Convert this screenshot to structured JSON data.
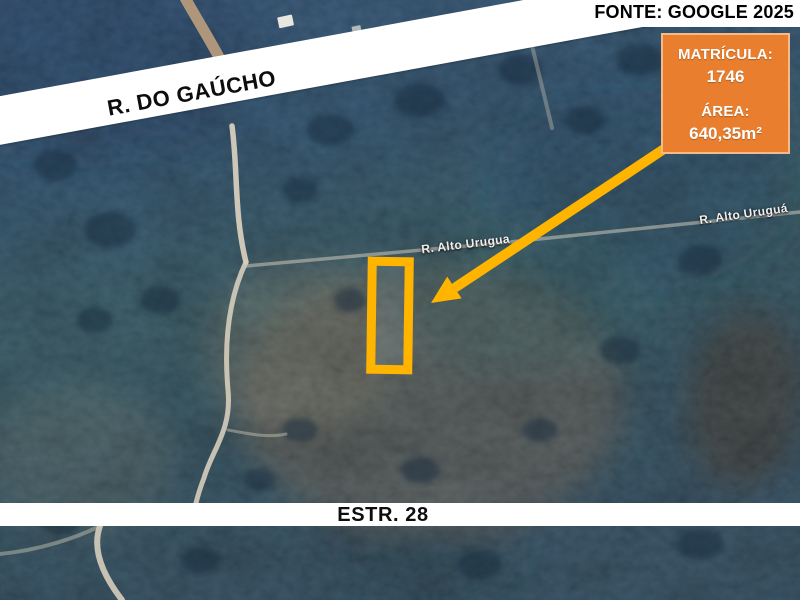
{
  "figure": {
    "source_credit": "FONTE: GOOGLE 2025"
  },
  "bands": {
    "top_road_label": "R. DO GAÚCHO",
    "bottom_road_label": "ESTR. 28"
  },
  "road_labels": {
    "middle": "R. Alto Urugua",
    "right": "R. Alto Uruguá"
  },
  "info_box": {
    "matricula_label": "MATRÍCULA:",
    "matricula_value": "1746",
    "area_label": "ÁREA:",
    "area_value": "640,35m²"
  },
  "colors": {
    "info_box_bg": "#E87E2E",
    "highlight": "#FFB400",
    "band_bg": "#FFFFFF",
    "band_text": "#0D0D0D"
  }
}
